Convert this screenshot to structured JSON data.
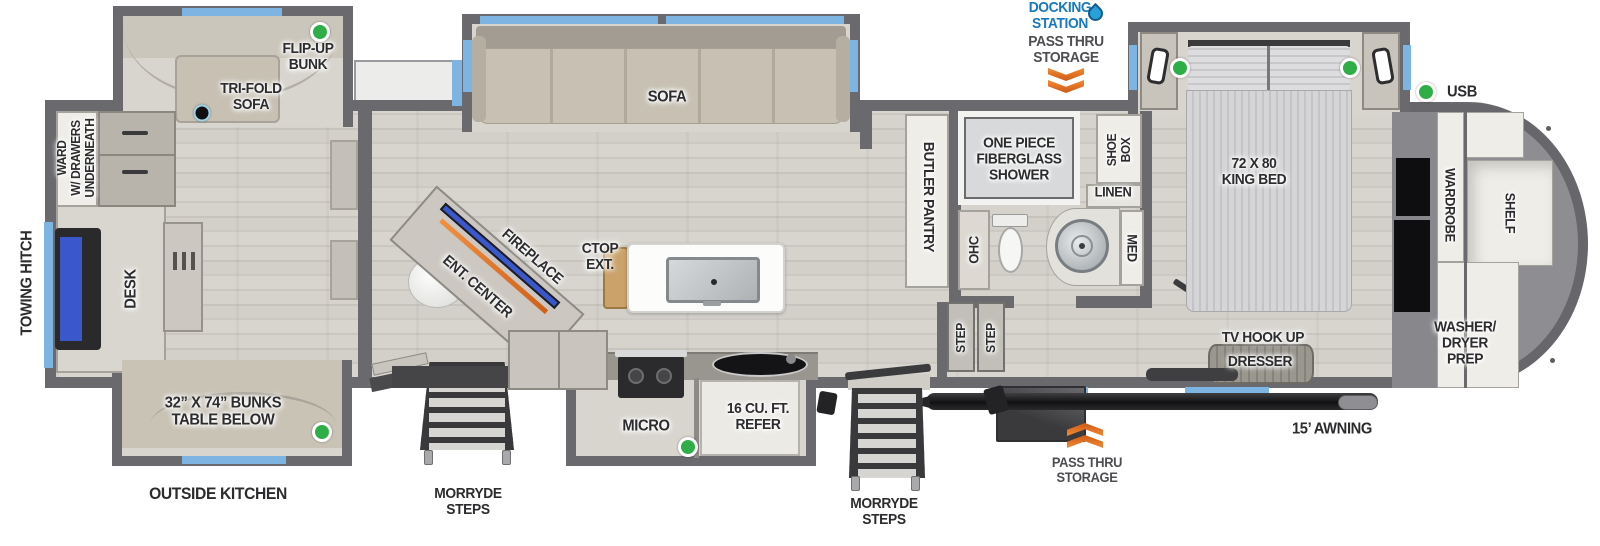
{
  "colors": {
    "wall": "#6a6a6e",
    "floor": "#d5d2cc",
    "window_blue": "#7db4e2",
    "marker_green": "#2fae47",
    "marker_black": "#101012",
    "arrow_orange": "#e8731f",
    "docking_blue": "#1779be",
    "awning_black": "#1b1b1d"
  },
  "exterior": {
    "docking_station": "DOCKING\nSTATION",
    "pass_thru": "PASS THRU\nSTORAGE",
    "towing_hitch": "TOWING HITCH",
    "outside_kitchen": "OUTSIDE KITCHEN",
    "morryde_steps": "MORRYDE\nSTEPS",
    "awning": "15’ AWNING",
    "usb": "USB"
  },
  "rear_room": {
    "flip_up_bunk": "FLIP-UP\nBUNK",
    "tri_fold_sofa": "TRI-FOLD\nSOFA",
    "ward": "WARD\nW/ DRAWERS\nUNDERNEATH",
    "desk": "DESK",
    "bunks": "32” X 74” BUNKS\nTABLE BELOW"
  },
  "living_room": {
    "sofa": "SOFA",
    "ent_center": "ENT. CENTER",
    "fireplace": "FIREPLACE",
    "ctop_ext": "CTOP\nEXT."
  },
  "kitchen": {
    "micro": "MICRO",
    "refer": "16 CU. FT.\nREFER",
    "butler_pantry": "BUTLER PANTRY"
  },
  "bathroom": {
    "shower": "ONE PIECE\nFIBERGLASS\nSHOWER",
    "shoe_box": "SHOE\nBOX",
    "linen": "LINEN",
    "ohc": "OHC",
    "med": "MED",
    "step": "STEP"
  },
  "bedroom": {
    "king_bed": "72 X 80\nKING BED",
    "tv_hook_up": "TV HOOK UP",
    "dresser": "DRESSER"
  },
  "front_cap": {
    "wardrobe": "WARDROBE",
    "shelf": "SHELF",
    "washer_dryer": "WASHER/\nDRYER\nPREP"
  }
}
